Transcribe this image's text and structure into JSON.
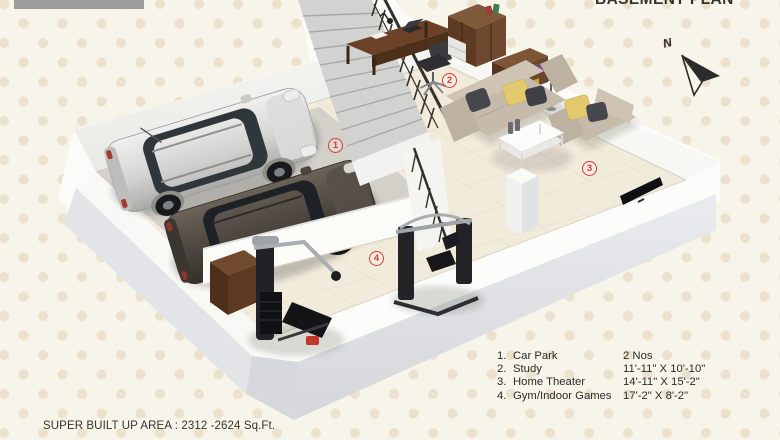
{
  "title": "BASEMENT PLAN",
  "compass": {
    "label": "N"
  },
  "legend": {
    "items": [
      {
        "no": "1.",
        "label": "Car Park",
        "value": "2 Nos"
      },
      {
        "no": "2.",
        "label": "Study",
        "value": "11'-11\" X 10'-10\""
      },
      {
        "no": "3.",
        "label": "Home Theater",
        "value": "14'-11\" X 15'-2\""
      },
      {
        "no": "4.",
        "label": "Gym/Indoor Games",
        "value": "17'-2\" X 8'-2\""
      }
    ]
  },
  "markers": [
    "1",
    "2",
    "3",
    "4"
  ],
  "footer": {
    "area_text": "SUPER BUILT UP AREA : 2312 -2624 Sq.Ft."
  },
  "colors": {
    "accent": "#d83a34",
    "ink": "#35332c",
    "bg": "#f7f4ea",
    "dot": "#ebe1cd",
    "bar": "#9c9c9a"
  }
}
